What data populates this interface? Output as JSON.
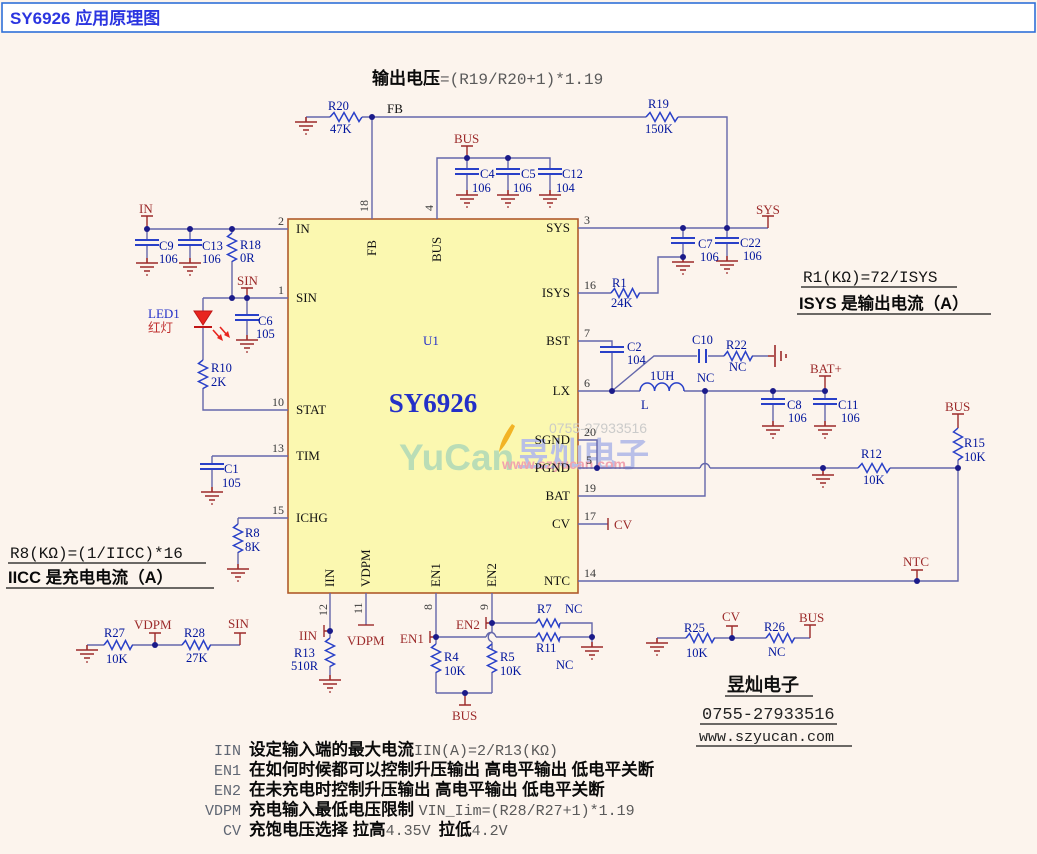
{
  "title": "SY6926 应用原理图",
  "header_formula": {
    "label": "输出电压",
    "expr": "=(R19/R20+1)*1.19"
  },
  "annotations": {
    "r1_formula": "R1(KΩ)=72/ISYS",
    "r1_desc": "ISYS 是输出电流（A）",
    "r8_formula": "R8(KΩ)=(1/IICC)*16",
    "r8_desc": "IICC 是充电电流（A）"
  },
  "vendor": {
    "name": "昱灿电子",
    "phone": "0755-27933516",
    "website": "www.szyucan.com"
  },
  "watermark": {
    "logo": "YuCan",
    "name": "昱灿电子",
    "phone": "0755-27933516",
    "website": "www.szyucan.com"
  },
  "notes": [
    {
      "tag": "IIN",
      "text": "设定输入端的最大电流",
      "formula": "IIN(A)=2/R13(KΩ)"
    },
    {
      "tag": "EN1",
      "text": "在如何时候都可以控制升压输出  高电平输出 低电平关断",
      "formula": ""
    },
    {
      "tag": "EN2",
      "text": "在未充电时控制升压输出 高电平输出 低电平关断",
      "formula": ""
    },
    {
      "tag": "VDPM",
      "text": "充电输入最低电压限制 ",
      "formula": "VIN_Iim=(R28/R27+1)*1.19"
    },
    {
      "tag": "CV",
      "text": "充饱电压选择  拉高",
      "formula": "4.35V",
      "text2": "拉低",
      "formula2": "4.2V"
    }
  ],
  "ic": {
    "ref": "U1",
    "part": "SY6926",
    "pins_left": [
      {
        "num": "2",
        "name": "IN"
      },
      {
        "num": "1",
        "name": "SIN"
      },
      {
        "num": "10",
        "name": "STAT"
      },
      {
        "num": "13",
        "name": "TIM"
      },
      {
        "num": "15",
        "name": "ICHG"
      }
    ],
    "pins_top": [
      {
        "num": "18",
        "name": "FB"
      },
      {
        "num": "4",
        "name": "BUS"
      }
    ],
    "pins_right": [
      {
        "num": "3",
        "name": "SYS"
      },
      {
        "num": "16",
        "name": "ISYS"
      },
      {
        "num": "7",
        "name": "BST"
      },
      {
        "num": "6",
        "name": "LX"
      },
      {
        "num": "20",
        "name": "SGND"
      },
      {
        "num": "5",
        "name": "PGND"
      },
      {
        "num": "19",
        "name": "BAT"
      },
      {
        "num": "17",
        "name": "CV"
      },
      {
        "num": "14",
        "name": "NTC"
      }
    ],
    "pins_bottom": [
      {
        "num": "12",
        "name": "IIN"
      },
      {
        "num": "11",
        "name": "VDPM"
      },
      {
        "num": "8",
        "name": "EN1"
      },
      {
        "num": "9",
        "name": "EN2"
      }
    ]
  },
  "parts": {
    "R20": {
      "ref": "R20",
      "val": "47K"
    },
    "R19": {
      "ref": "R19",
      "val": "150K"
    },
    "C4": {
      "ref": "C4",
      "val": "106"
    },
    "C5": {
      "ref": "C5",
      "val": "106"
    },
    "C12": {
      "ref": "C12",
      "val": "104"
    },
    "C9": {
      "ref": "C9",
      "val": "106"
    },
    "C13": {
      "ref": "C13",
      "val": "106"
    },
    "R18": {
      "ref": "R18",
      "val": "0R"
    },
    "C6": {
      "ref": "C6",
      "val": "105"
    },
    "LED1": {
      "ref": "LED1",
      "val": "红灯"
    },
    "R10": {
      "ref": "R10",
      "val": "2K"
    },
    "C1": {
      "ref": "C1",
      "val": "105"
    },
    "R8": {
      "ref": "R8",
      "val": "8K"
    },
    "C7": {
      "ref": "C7",
      "val": "106"
    },
    "C22": {
      "ref": "C22",
      "val": "106"
    },
    "R1": {
      "ref": "R1",
      "val": "24K"
    },
    "C2": {
      "ref": "C2",
      "val": "104"
    },
    "C10": {
      "ref": "C10",
      "val": "NC"
    },
    "R22": {
      "ref": "R22",
      "val": "NC"
    },
    "L": {
      "ref": "L",
      "val": "1UH"
    },
    "C8": {
      "ref": "C8",
      "val": "106"
    },
    "C11": {
      "ref": "C11",
      "val": "106"
    },
    "R15": {
      "ref": "R15",
      "val": "10K"
    },
    "R12": {
      "ref": "R12",
      "val": "10K"
    },
    "R13": {
      "ref": "R13",
      "val": "510R"
    },
    "R4": {
      "ref": "R4",
      "val": "10K"
    },
    "R5": {
      "ref": "R5",
      "val": "10K"
    },
    "R7": {
      "ref": "R7",
      "val": "NC"
    },
    "R11": {
      "ref": "R11",
      "val": "NC"
    },
    "R27": {
      "ref": "R27",
      "val": "10K"
    },
    "R28": {
      "ref": "R28",
      "val": "27K"
    },
    "R25": {
      "ref": "R25",
      "val": "10K"
    },
    "R26": {
      "ref": "R26",
      "val": "NC"
    }
  },
  "nets": {
    "in": "IN",
    "sin": "SIN",
    "bus": "BUS",
    "sys": "SYS",
    "fb": "FB",
    "batp": "BAT+",
    "ntc": "NTC",
    "cv": "CV",
    "vdpm": "VDPM",
    "iin": "IIN",
    "en1": "EN1",
    "en2": "EN2"
  },
  "colors": {
    "wire": "#6467ab",
    "component": "#2940c8",
    "net_label": "#9c2a2a",
    "ic_fill": "#fbf8b0",
    "ic_border": "#b05a2c",
    "title_blue": "#2b35e0",
    "led_red": "#e8251f"
  }
}
